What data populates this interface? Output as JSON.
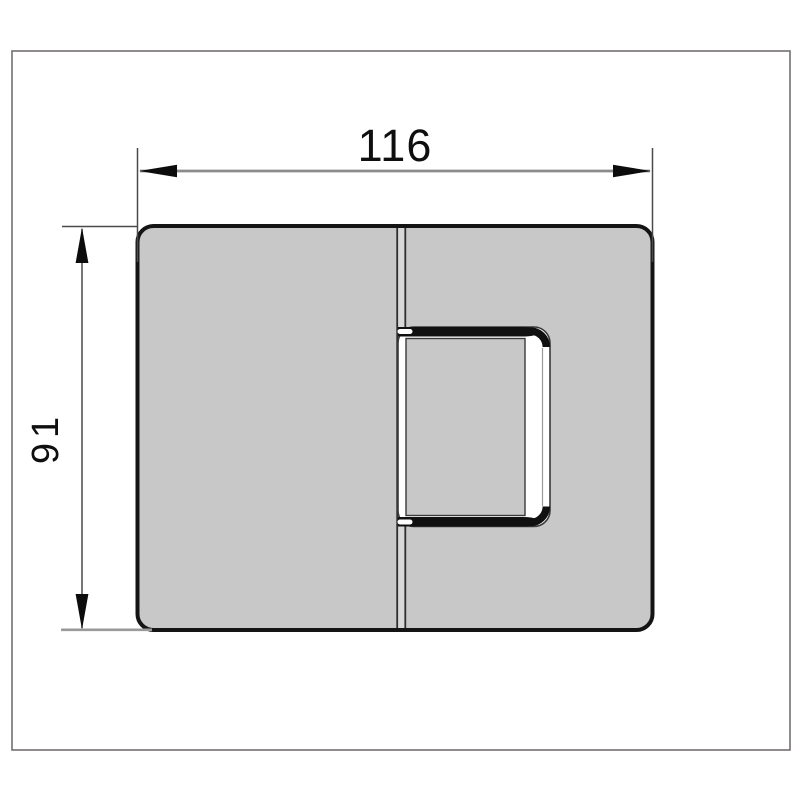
{
  "drawing": {
    "title": "hinge-dimension-drawing",
    "width_dimension": "116",
    "height_dimension": "91"
  },
  "colors": {
    "background": "#ffffff",
    "frame": "#766f6f",
    "body_fill": "#c8c8c8",
    "body_outline": "#141414",
    "split_gap_fill": "#d8d8d8",
    "split_line": "#2e2e2e",
    "dimension_line": "#8c8c8c",
    "extension_line": "#4a4a4a",
    "arrow_fill": "#0c0c0c",
    "label_color": "#0f0f0f",
    "clamp_face": "#ffffff",
    "clamp_bar": "#101010",
    "clamp_edge": "#3a3a3a"
  }
}
